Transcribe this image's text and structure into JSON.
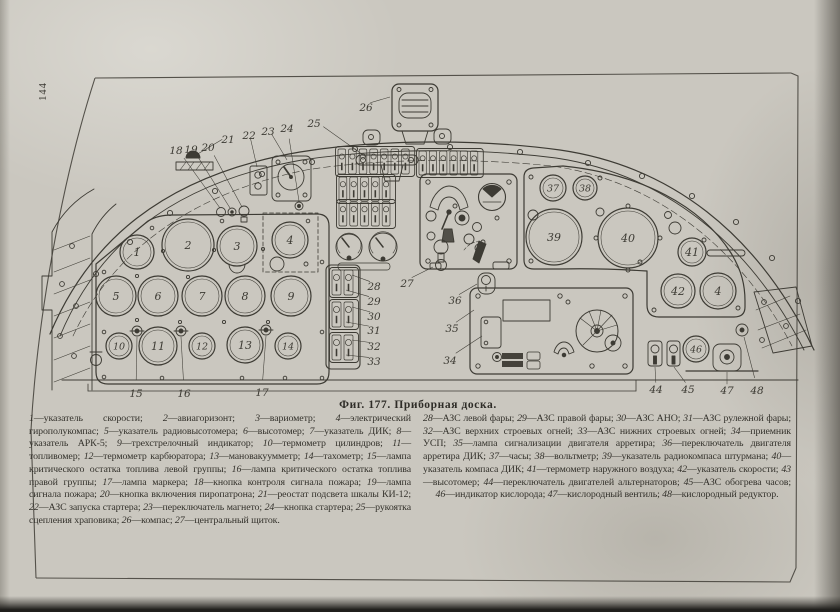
{
  "page": {
    "number": "144"
  },
  "figure": {
    "caption": "Фиг. 177. Приборная доска."
  },
  "legend": {
    "left": [
      {
        "n": "1",
        "t": "указатель скорости"
      },
      {
        "n": "2",
        "t": "авиагоризонт"
      },
      {
        "n": "3",
        "t": "вариометр"
      },
      {
        "n": "4",
        "t": "электрический гирополукомпас"
      },
      {
        "n": "5",
        "t": "указатель радиовысотомера"
      },
      {
        "n": "6",
        "t": "высотомер"
      },
      {
        "n": "7",
        "t": "указатель ДИК"
      },
      {
        "n": "8",
        "t": "указатель АРК-5"
      },
      {
        "n": "9",
        "t": "трехстрелочный индикатор"
      },
      {
        "n": "10",
        "t": "термометр цилиндров"
      },
      {
        "n": "11",
        "t": "топливомер"
      },
      {
        "n": "12",
        "t": "термометр карбюратора"
      },
      {
        "n": "13",
        "t": "мановакуумметр"
      },
      {
        "n": "14",
        "t": "тахометр"
      },
      {
        "n": "15",
        "t": "лампа критического остатка топлива левой группы"
      },
      {
        "n": "16",
        "t": "лампа критического остатка топлива правой группы"
      },
      {
        "n": "17",
        "t": "лампа маркера"
      },
      {
        "n": "18",
        "t": "кнопка контроля сигнала пожара"
      },
      {
        "n": "19",
        "t": "лампа сигнала пожара"
      },
      {
        "n": "20",
        "t": "кнопка включения пиропатрона"
      },
      {
        "n": "21",
        "t": "реостат подсвета шкалы КИ-12"
      },
      {
        "n": "22",
        "t": "АЗС запуска стартера"
      },
      {
        "n": "23",
        "t": "переключатель магнето"
      },
      {
        "n": "24",
        "t": "кнопка стартера"
      },
      {
        "n": "25",
        "t": "рукоятка сцепления храповика"
      },
      {
        "n": "26",
        "t": "компас"
      },
      {
        "n": "27",
        "t": "центральный щиток"
      }
    ],
    "right": [
      {
        "n": "28",
        "t": "АЗС левой фары"
      },
      {
        "n": "29",
        "t": "АЗС правой фары"
      },
      {
        "n": "30",
        "t": "АЗС АНО"
      },
      {
        "n": "31",
        "t": "АЗС рулежной фары"
      },
      {
        "n": "32",
        "t": "АЗС верхних строевых огней"
      },
      {
        "n": "33",
        "t": "АЗС нижних строевых огней"
      },
      {
        "n": "34",
        "t": "приемник УСП"
      },
      {
        "n": "35",
        "t": "лампа сигнализации двигателя арретира"
      },
      {
        "n": "36",
        "t": "переключатель двигателя арретира ДИК"
      },
      {
        "n": "37",
        "t": "часы"
      },
      {
        "n": "38",
        "t": "вольтметр"
      },
      {
        "n": "39",
        "t": "указатель радиокомпаса штурмана"
      },
      {
        "n": "40",
        "t": "указатель компаса ДИК"
      },
      {
        "n": "41",
        "t": "термометр наружного воздуха"
      },
      {
        "n": "42",
        "t": "указатель скорости"
      },
      {
        "n": "43",
        "t": "высотомер"
      },
      {
        "n": "44",
        "t": "переключатель двигателей альтернаторов"
      },
      {
        "n": "45",
        "t": "АЗС обогрева часов"
      },
      {
        "n": "46",
        "t": "индикатор кислорода"
      },
      {
        "n": "47",
        "t": "кислородный вентиль"
      },
      {
        "n": "48",
        "t": "кислородный редуктор"
      }
    ]
  },
  "diagram": {
    "ink": "#3d3b34",
    "gauges": [
      {
        "n": "1",
        "x": 137,
        "y": 252,
        "r": 17
      },
      {
        "n": "2",
        "x": 188,
        "y": 245,
        "r": 26
      },
      {
        "n": "3",
        "x": 237,
        "y": 246,
        "r": 20
      },
      {
        "n": "4",
        "x": 290,
        "y": 240,
        "r": 18
      },
      {
        "n": "5",
        "x": 116,
        "y": 296,
        "r": 20
      },
      {
        "n": "6",
        "x": 158,
        "y": 296,
        "r": 20
      },
      {
        "n": "7",
        "x": 202,
        "y": 296,
        "r": 20
      },
      {
        "n": "8",
        "x": 245,
        "y": 296,
        "r": 20
      },
      {
        "n": "9",
        "x": 291,
        "y": 296,
        "r": 20
      },
      {
        "n": "10",
        "x": 119,
        "y": 346,
        "r": 13
      },
      {
        "n": "11",
        "x": 158,
        "y": 346,
        "r": 19
      },
      {
        "n": "12",
        "x": 202,
        "y": 346,
        "r": 13
      },
      {
        "n": "13",
        "x": 245,
        "y": 345,
        "r": 18
      },
      {
        "n": "14",
        "x": 288,
        "y": 346,
        "r": 13
      },
      {
        "n": "37",
        "x": 553,
        "y": 188,
        "r": 13
      },
      {
        "n": "38",
        "x": 585,
        "y": 188,
        "r": 12
      },
      {
        "n": "39",
        "x": 554,
        "y": 237,
        "r": 28
      },
      {
        "n": "40",
        "x": 628,
        "y": 238,
        "r": 30
      },
      {
        "n": "41",
        "x": 692,
        "y": 252,
        "r": 14
      },
      {
        "n": "42",
        "x": 678,
        "y": 291,
        "r": 17
      },
      {
        "n": "4",
        "id": "43",
        "x": 718,
        "y": 291,
        "r": 18
      },
      {
        "n": "46",
        "x": 696,
        "y": 349,
        "r": 13
      }
    ],
    "callouts": [
      {
        "n": "15",
        "x": 136,
        "y": 394,
        "t": [
          137,
          337
        ]
      },
      {
        "n": "16",
        "x": 184,
        "y": 394,
        "t": [
          181,
          337
        ]
      },
      {
        "n": "17",
        "x": 262,
        "y": 393,
        "t": [
          266,
          336
        ]
      },
      {
        "n": "18",
        "x": 176,
        "y": 151,
        "t": [
          220,
          208
        ]
      },
      {
        "n": "19",
        "x": 191,
        "y": 150,
        "t": [
          230,
          208
        ]
      },
      {
        "n": "20",
        "x": 208,
        "y": 148,
        "t": [
          242,
          207
        ]
      },
      {
        "n": "21",
        "x": 228,
        "y": 140,
        "t": [
          196,
          155
        ]
      },
      {
        "n": "22",
        "x": 249,
        "y": 136,
        "t": [
          257,
          167
        ]
      },
      {
        "n": "23",
        "x": 268,
        "y": 132,
        "t": [
          287,
          160
        ]
      },
      {
        "n": "24",
        "x": 287,
        "y": 129,
        "t": [
          299,
          201
        ]
      },
      {
        "n": "25",
        "x": 314,
        "y": 124,
        "t": [
          366,
          157
        ]
      },
      {
        "n": "26",
        "x": 366,
        "y": 108,
        "t": [
          390,
          97
        ]
      },
      {
        "n": "27",
        "x": 407,
        "y": 284,
        "t": [
          433,
          267
        ]
      },
      {
        "n": "28",
        "x": 374,
        "y": 287,
        "t": [
          352,
          275
        ]
      },
      {
        "n": "29",
        "x": 374,
        "y": 302,
        "t": [
          346,
          290
        ]
      },
      {
        "n": "30",
        "x": 374,
        "y": 317,
        "t": [
          352,
          307
        ]
      },
      {
        "n": "31",
        "x": 374,
        "y": 331,
        "t": [
          346,
          322
        ]
      },
      {
        "n": "32",
        "x": 374,
        "y": 347,
        "t": [
          352,
          340
        ]
      },
      {
        "n": "33",
        "x": 374,
        "y": 362,
        "t": [
          346,
          355
        ]
      },
      {
        "n": "34",
        "x": 450,
        "y": 361,
        "t": [
          482,
          336
        ]
      },
      {
        "n": "35",
        "x": 452,
        "y": 329,
        "t": [
          474,
          310
        ]
      },
      {
        "n": "36",
        "x": 455,
        "y": 301,
        "t": [
          477,
          284
        ]
      },
      {
        "n": "44",
        "x": 656,
        "y": 390,
        "t": [
          655,
          367
        ]
      },
      {
        "n": "45",
        "x": 688,
        "y": 390,
        "t": [
          674,
          367
        ]
      },
      {
        "n": "47",
        "x": 727,
        "y": 391,
        "t": [
          727,
          372
        ]
      },
      {
        "n": "48",
        "x": 757,
        "y": 391,
        "t": [
          744,
          337
        ]
      }
    ],
    "switch_banks": [
      {
        "x": 338,
        "y": 149,
        "n": 7,
        "p": 10.6,
        "h": 25
      },
      {
        "x": 419,
        "y": 151,
        "n": 6,
        "p": 10.3,
        "h": 24
      },
      {
        "x": 339,
        "y": 177,
        "n": 5,
        "p": 10.8,
        "h": 24
      },
      {
        "x": 339,
        "y": 202,
        "n": 5,
        "p": 10.8,
        "h": 24
      },
      {
        "x": 332,
        "y": 270,
        "n": 2,
        "p": 12,
        "h": 25
      },
      {
        "x": 332,
        "y": 302,
        "n": 2,
        "p": 12,
        "h": 25
      },
      {
        "x": 332,
        "y": 335,
        "n": 2,
        "p": 12,
        "h": 25
      }
    ]
  }
}
